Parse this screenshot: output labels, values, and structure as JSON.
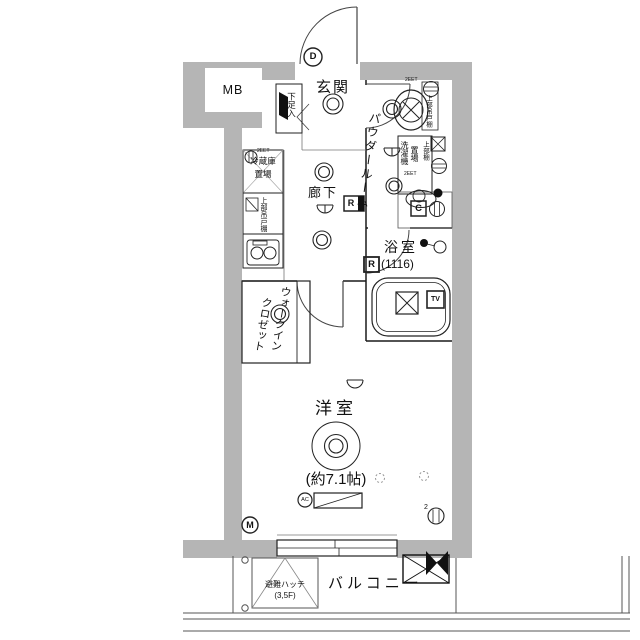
{
  "floorplan": {
    "rooms": {
      "mb": "MB",
      "genkan": "玄関",
      "powder_room": "パウダールーム",
      "hallway": "廊下",
      "bathroom": "浴室",
      "bathroom_size": "(1116)",
      "wic_line1": "ウォークイン",
      "wic_line2": "クロゼット",
      "western_room": "洋室",
      "western_room_size": "(約7.1帖)",
      "balcony": "バルコニー"
    },
    "fixtures": {
      "shoe_cabinet": "下足入",
      "refrigerator_line1": "冷蔵庫",
      "refrigerator_line2": "置場",
      "kitchen_upper_cabinet": "上部吊戸棚",
      "toilet_upper_cabinet": "上部吊戸棚",
      "washer_line1": "洗濯機",
      "washer_line2": "置場",
      "washer_upper_shelf": "上部棚",
      "escape_hatch_line1": "避難ハッチ",
      "escape_hatch_line2": "(3,5F)"
    },
    "markers": {
      "d": "D",
      "m": "M",
      "r_hall": "R",
      "r_bath": "R",
      "c": "C",
      "ac": "AC",
      "tv": "TV",
      "outlet_spec_fridge": "2EET",
      "outlet_spec_toilet": "2EET",
      "outlet_spec_washer": "2EET",
      "outlet_count": "2"
    },
    "colors": {
      "wall": "#b5b5b5",
      "line": "#1a1a1a"
    }
  }
}
